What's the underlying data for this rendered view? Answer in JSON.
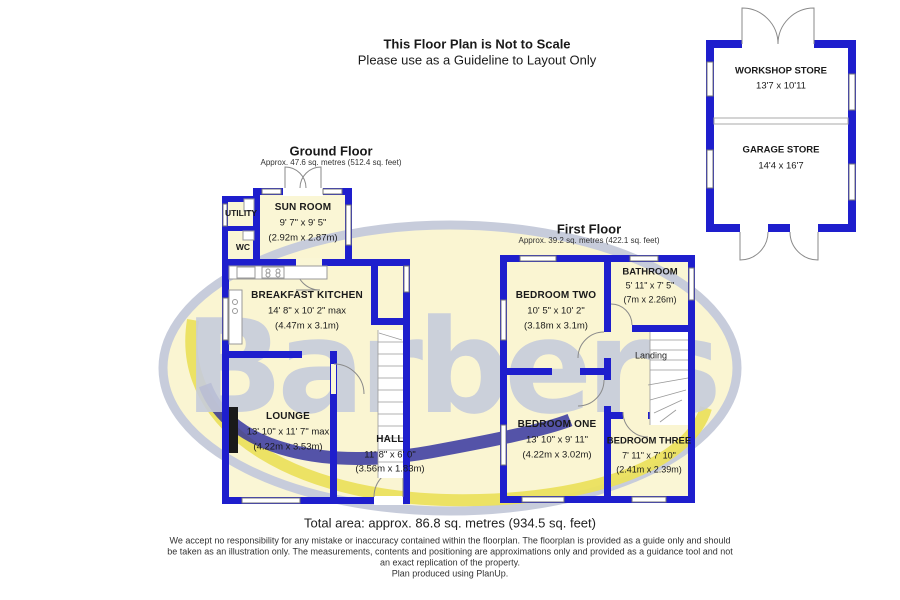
{
  "header": {
    "title": "This Floor Plan is Not to Scale",
    "subtitle": "Please use as a Guideline to Layout Only"
  },
  "ground_floor": {
    "title": "Ground Floor",
    "area": "Approx. 47.6 sq. metres (512.4 sq. feet)",
    "rooms": {
      "utility": {
        "name": "UTILITY"
      },
      "wc": {
        "name": "WC"
      },
      "sun_room": {
        "name": "SUN ROOM",
        "imperial": "9' 7\" x 9' 5\"",
        "metric": "(2.92m x 2.87m)"
      },
      "breakfast_kitchen": {
        "name": "BREAKFAST KITCHEN",
        "imperial": "14' 8\" x 10' 2\" max",
        "metric": "(4.47m x 3.1m)"
      },
      "lounge": {
        "name": "LOUNGE",
        "imperial": "13' 10\" x 11' 7\" max",
        "metric": "(4.22m x 3.53m)"
      },
      "hall": {
        "name": "HALL",
        "imperial": "11' 8\" x 6' 0\"",
        "metric": "(3.56m x 1.83m)"
      }
    }
  },
  "first_floor": {
    "title": "First Floor",
    "area": "Approx. 39.2 sq. metres (422.1 sq. feet)",
    "rooms": {
      "bedroom_two": {
        "name": "BEDROOM TWO",
        "imperial": "10' 5\" x 10' 2\"",
        "metric": "(3.18m x 3.1m)"
      },
      "bathroom": {
        "name": "BATHROOM",
        "imperial": "5' 11\" x 7' 5\"",
        "metric": "(7m x 2.26m)"
      },
      "landing": {
        "name": "Landing"
      },
      "bedroom_one": {
        "name": "BEDROOM ONE",
        "imperial": "13' 10\" x 9' 11\"",
        "metric": "(4.22m x 3.02m)"
      },
      "bedroom_three": {
        "name": "BEDROOM THREE",
        "imperial": "7' 11\" x 7' 10\"",
        "metric": "(2.41m x 2.39m)"
      }
    }
  },
  "outbuilding": {
    "workshop_store": {
      "name": "WORKSHOP STORE",
      "dims": "13'7 x 10'11"
    },
    "garage_store": {
      "name": "GARAGE STORE",
      "dims": "14'4 x 16'7"
    }
  },
  "footer": {
    "total_area": "Total area: approx. 86.8 sq. metres (934.5 sq. feet)",
    "disclaimer_line1": "We accept no responsibility for any mistake or inaccuracy contained within the floorplan. The floorplan is provided as a guide only and should",
    "disclaimer_line2": "be taken as an illustration only. The measurements, contents and positioning are approximations only and provided as a guidance tool and not",
    "disclaimer_line3": "an exact replication of the property.",
    "disclaimer_line4": "Plan produced using PlanUp."
  },
  "watermark": {
    "text": "Barbers"
  },
  "colors": {
    "wall": "#1e1ecd",
    "room_fill": "#faf6d5",
    "watermark_gray_blue": "#c7ccdb",
    "watermark_yellow": "#ebe05e",
    "watermark_navy": "#2b2b9e",
    "text": "#1a1a1a",
    "background": "#ffffff"
  }
}
